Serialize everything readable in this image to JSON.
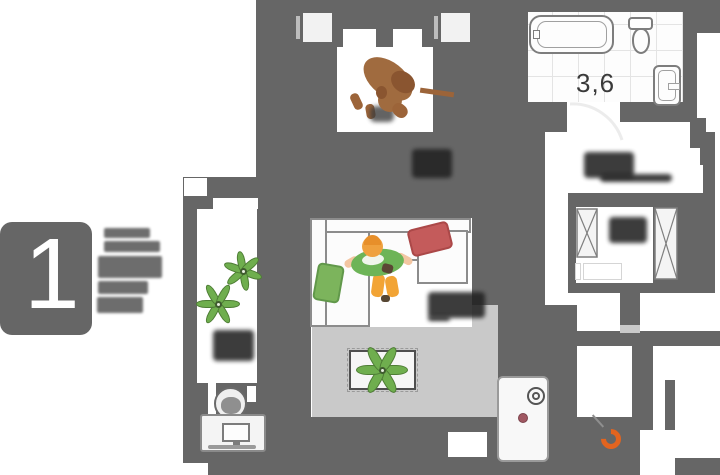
{
  "plan": {
    "unit_number": "1",
    "bathroom_area_label": "3,6"
  },
  "icons": {
    "fixtures": [
      "bathtub",
      "toilet",
      "sink",
      "wardrobe-crossbox",
      "boiler-unit",
      "desk-with-monitor",
      "office-chair",
      "plant",
      "sofa",
      "person",
      "dog",
      "vent-shaft",
      "door-arc",
      "orange-hose-ring"
    ]
  },
  "colors": {
    "wall": "#666666",
    "floor": "#c9c9c9",
    "accent-green": "#6fae4e",
    "accent-red": "#c45b5b",
    "accent-orange": "#e2641f",
    "label-dark": "#222222",
    "dog-brown": "#a06b3f",
    "person-hair": "#efa13e"
  }
}
